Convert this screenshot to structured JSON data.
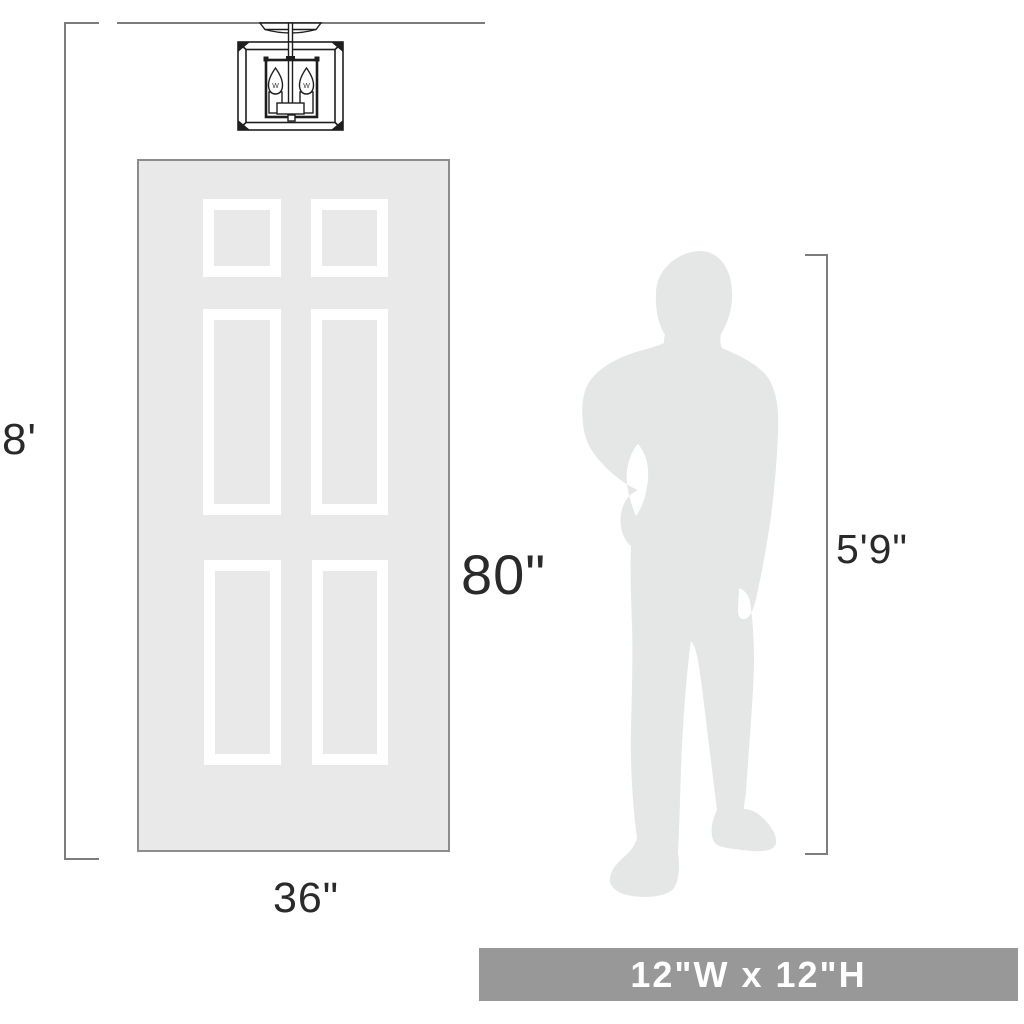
{
  "diagram": {
    "ceiling_height_label": "8'",
    "door": {
      "height_label": "80\"",
      "width_label": "36\"",
      "panel_count": 6
    },
    "person_height_label": "5'9\"",
    "fixture": {
      "description": "two-light square cage semi-flush ceiling light",
      "bulb_marks": [
        "W",
        "W"
      ]
    },
    "size_banner": {
      "text": "12\"W x 12\"H"
    }
  },
  "colors": {
    "background": "#ffffff",
    "line": "#7d7d7d",
    "label_text": "#2a2a2a",
    "door_fill": "#e9e9e9",
    "door_border": "#8c8c8c",
    "panel_frame": "#ffffff",
    "silhouette": "#e5e6e6",
    "fixture_stroke": "#1e1e1e",
    "banner_bg": "#989898",
    "banner_text": "#ffffff"
  }
}
